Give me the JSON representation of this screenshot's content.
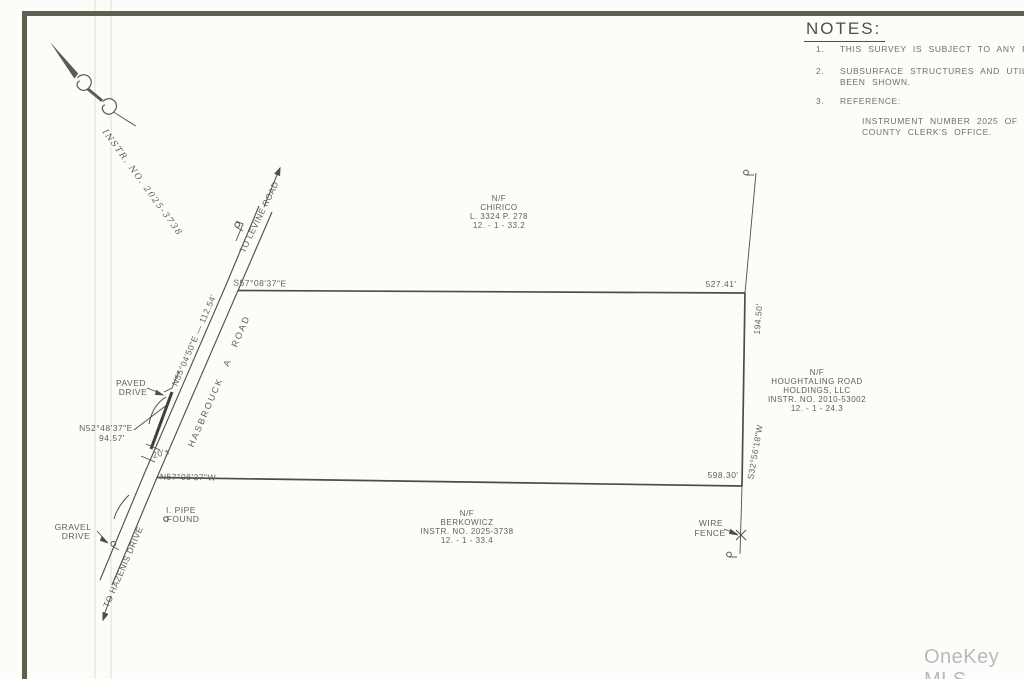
{
  "document": {
    "type_label": "land survey plat",
    "watermark": "OneKey MLS",
    "colors": {
      "border": "#5d6151",
      "linework": "#4c4c4c",
      "text": "#5e5e5e",
      "watermark": "#b7b9c0"
    }
  },
  "notes": {
    "title": "NOTES:",
    "items": [
      {
        "num": "1.",
        "lines": [
          "THIS SURVEY IS SUBJECT TO ANY FINDI"
        ]
      },
      {
        "num": "2.",
        "lines": [
          "SUBSURFACE STRUCTURES AND UTILITIES",
          "BEEN SHOWN."
        ]
      },
      {
        "num": "3.",
        "lines": [
          "REFERENCE:"
        ]
      }
    ],
    "reference": [
      "INSTRUMENT NUMBER 2025 OF DEEDS",
      "COUNTY CLERK'S OFFICE."
    ]
  },
  "compass": {
    "instr_label": "INSTR. NO. 2025-3738"
  },
  "roads": {
    "name": "HASBROUCK  A  ROAD",
    "to_levine": "TO LEVINE ROAD",
    "to_hazenis": "TO HAZENIS DRIVE",
    "width_label": "20'±",
    "paved_drive": [
      "PAVED",
      "DRIVE"
    ],
    "gravel_drive": [
      "GRAVEL",
      "DRIVE"
    ]
  },
  "bearings": {
    "top": "S57°08'37\"E",
    "bottom": "N57°08'37\"W",
    "right": "S32°56'18\"W",
    "road_frontage": "N55°04'50\"E — 112.54'",
    "drive_bearing": "N52°48'37\"E",
    "drive_length": "94.57'"
  },
  "dimensions": {
    "top_line": "527.41'",
    "right_extension": "194.50'",
    "bottom_line": "598.30'"
  },
  "parcels": {
    "chirico": [
      "N/F",
      "CHIRICO",
      "L. 3324 P. 278",
      "12. - 1 - 33.2"
    ],
    "houghtaling": [
      "N/F",
      "HOUGHTALING ROAD",
      "HOLDINGS, LLC",
      "INSTR. NO. 2010-53002",
      "12. - 1 - 24.3"
    ],
    "berkowicz": [
      "N/F",
      "BERKOWICZ",
      "INSTR. NO. 2025-3738",
      "12. - 1 - 33.4"
    ]
  },
  "markers": {
    "wire_fence": [
      "WIRE",
      "FENCE"
    ],
    "pipe_found": [
      "I. PIPE",
      "FOUND"
    ]
  }
}
